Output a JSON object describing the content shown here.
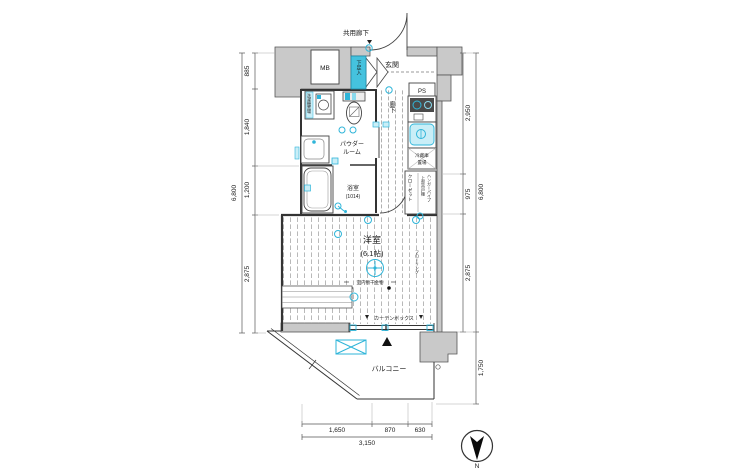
{
  "plan": {
    "common_corridor": "共用廊下",
    "mb": "MB",
    "shoe_box": "下足入",
    "entrance": "玄関",
    "ps": "PS",
    "washer_space": "洗濯機置場",
    "powder_room_line1": "パウダー",
    "powder_room_line2": "ルーム",
    "hallway": "廊下",
    "bathroom": "浴室",
    "bathroom_size": "(1014)",
    "fridge_line1": "冷蔵庫",
    "fridge_line2": "置場",
    "closet": "クローゼット",
    "closet_note_line1": "上部吊戸棚",
    "closet_note_line2": "ハンガーパイプ",
    "room": "洋室",
    "room_size": "(6.1帖)",
    "indoor_drying": "室内物干金物",
    "flooring_note": "フローリング",
    "curtain_box": "カーテンボックス",
    "balcony": "バルコニー"
  },
  "dimensions": {
    "left": [
      "885",
      "1,840",
      "1,200",
      "2,875"
    ],
    "left_total": "6,800",
    "right": [
      "2,950",
      "975",
      "2,875"
    ],
    "right_total": "6,800",
    "balcony_depth": "1,750",
    "bottom": [
      "1,650",
      "870",
      "630"
    ],
    "bottom_total": "3,150"
  },
  "compass": {
    "north": "N"
  },
  "colors": {
    "fixture_accent": "#2fb5d9",
    "wall_fill": "#c9c9c9"
  }
}
